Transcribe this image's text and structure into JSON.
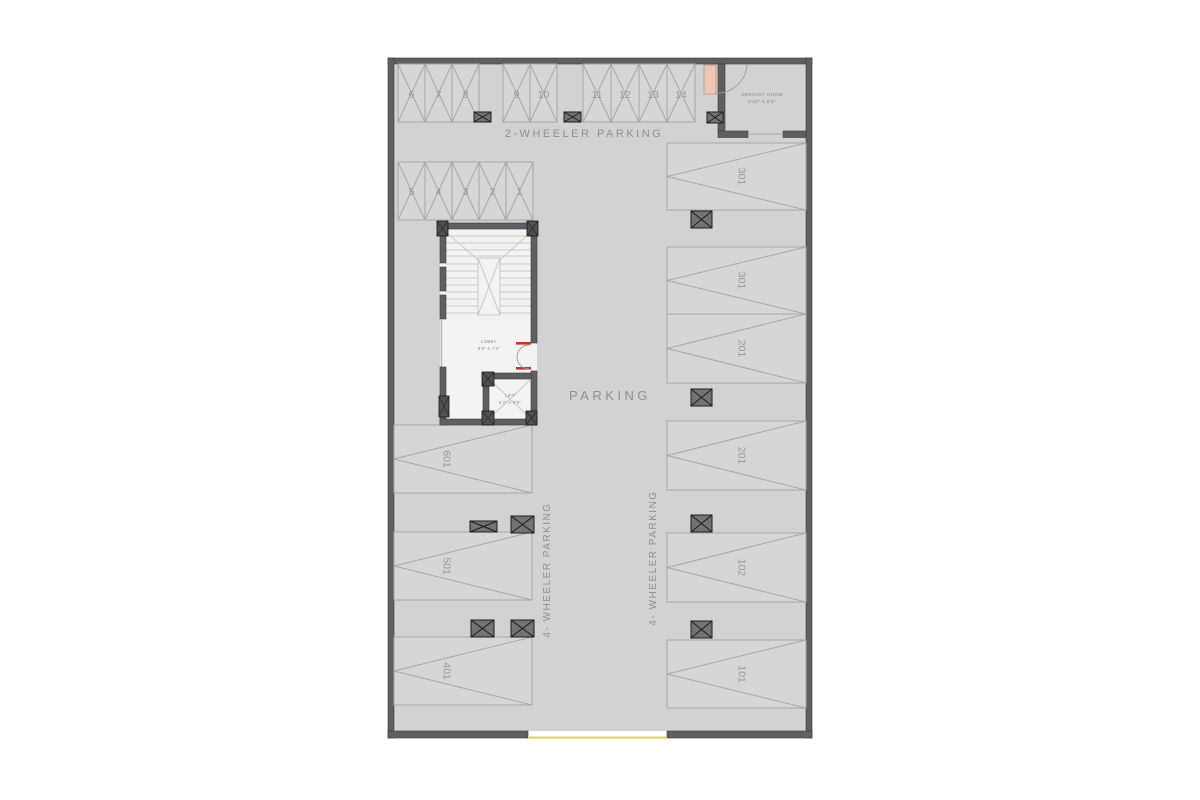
{
  "plan": {
    "floor_color": "#d2d2d3",
    "wall_color": "#5f5f61",
    "accent_red": "#b23b2e",
    "door_leaf_color": "#ecc7b1",
    "entry_line_color": "#d9d96a",
    "labels": {
      "two_wheeler": "2-WHEELER PARKING",
      "parking": "PARKING",
      "four_wheeler_left": "4- WHEELER PARKING",
      "four_wheeler_right": "4- WHEELER PARKING"
    },
    "rooms": {
      "servant": {
        "name": "SERVANT ROOM",
        "size": "9'10\" X 8'8\""
      },
      "lobby": {
        "name": "LOBBY",
        "size": "9'8\" X 7'4\""
      },
      "lift": {
        "name": "LIFT",
        "size": "5'2\" X 5'9\""
      }
    },
    "two_wheeler_slots": {
      "row1": [
        "6",
        "7",
        "8",
        "9",
        "10",
        "11",
        "12",
        "13",
        "14"
      ],
      "row2": [
        "5",
        "4",
        "3",
        "2",
        "1"
      ]
    },
    "four_wheeler_slots": {
      "left": [
        "601",
        "501",
        "401"
      ],
      "right": [
        "301",
        "301",
        "201",
        "201",
        "102",
        "101"
      ]
    }
  }
}
